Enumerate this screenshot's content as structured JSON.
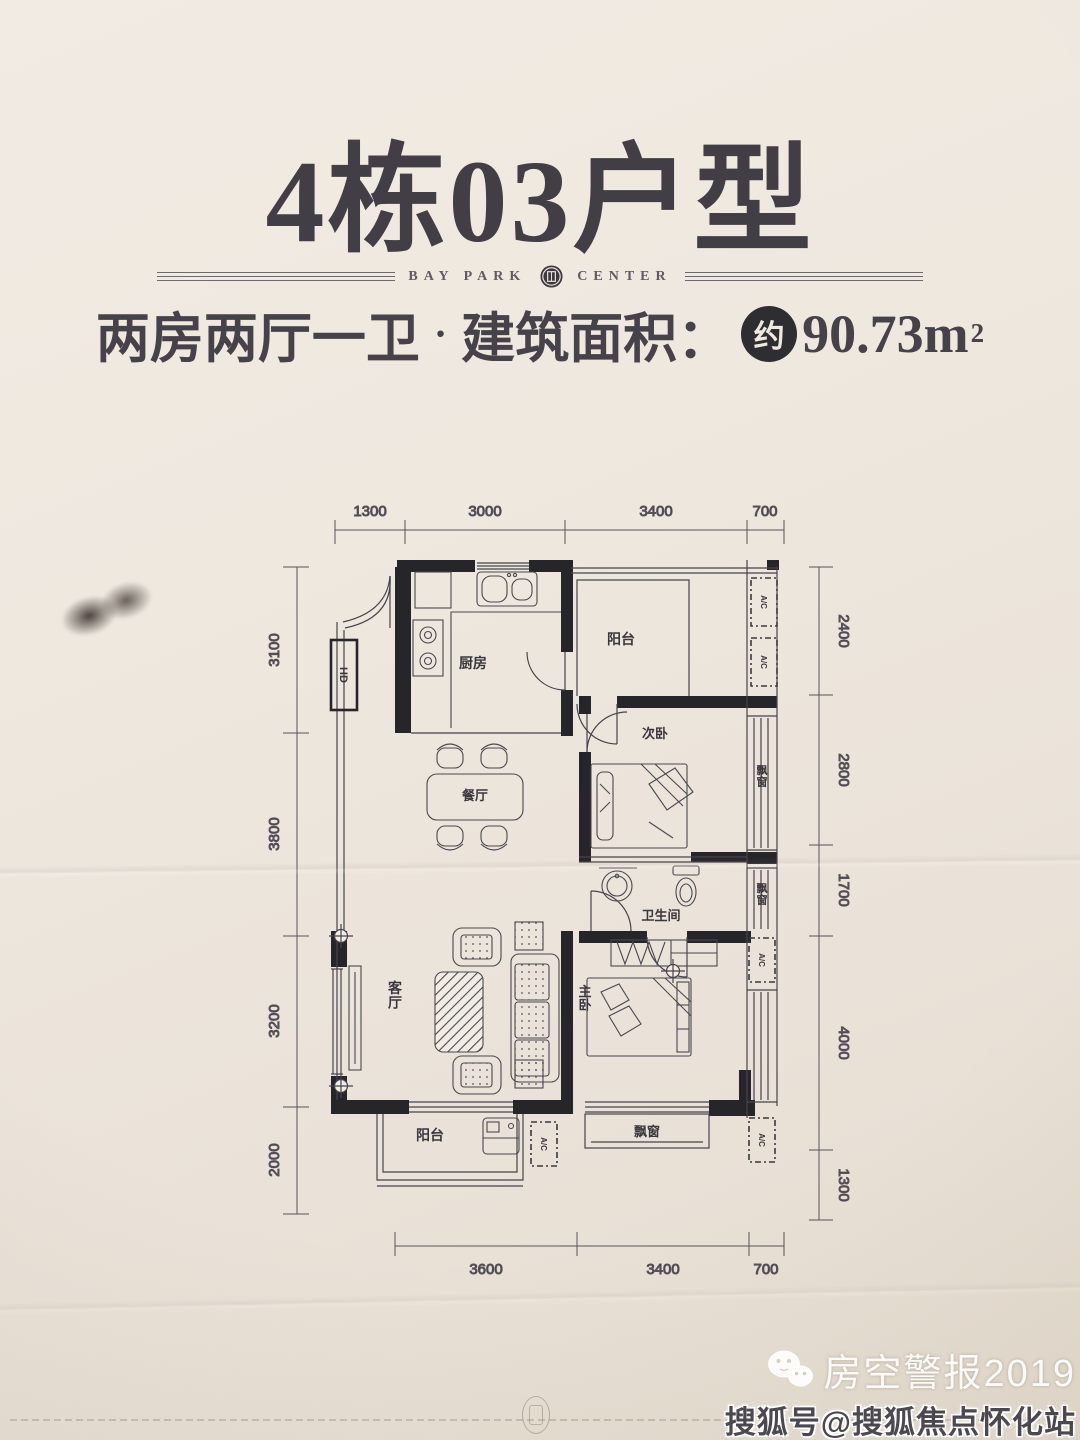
{
  "page": {
    "title": "4栋03户型",
    "brand": {
      "left": "BAY PARK",
      "right": "CENTER"
    },
    "subtitle": {
      "layout": "两房两厅一卫",
      "separator": "·",
      "area_label": "建筑面积：",
      "approx_badge": "约",
      "area_value": "90.73m",
      "area_exponent": "2"
    }
  },
  "floorplan": {
    "rooms": {
      "kitchen": "厨房",
      "balcony_top": "阳台",
      "bedroom_second": "次卧",
      "dining": "餐厅",
      "bathroom": "卫生间",
      "living": "客厅",
      "bedroom_master": "主卧",
      "balcony_bottom": "阳台",
      "bay_window_upper": "飘窗",
      "bay_window_lower": "飘窗",
      "bay_window_bottom": "飘窗"
    },
    "labels": {
      "flue": "HD",
      "ac_unit": "A/C"
    },
    "dimensions": {
      "top": [
        "1300",
        "3000",
        "3400",
        "700"
      ],
      "left": [
        "3100",
        "3800",
        "3200",
        "2000"
      ],
      "right": [
        "2400",
        "2800",
        "1700",
        "4000",
        "1300"
      ],
      "bottom": [
        "3600",
        "3400",
        "700"
      ]
    }
  },
  "watermark": {
    "publisher": "房空警报2019",
    "account": "搜狐号@搜狐焦点怀化站"
  }
}
